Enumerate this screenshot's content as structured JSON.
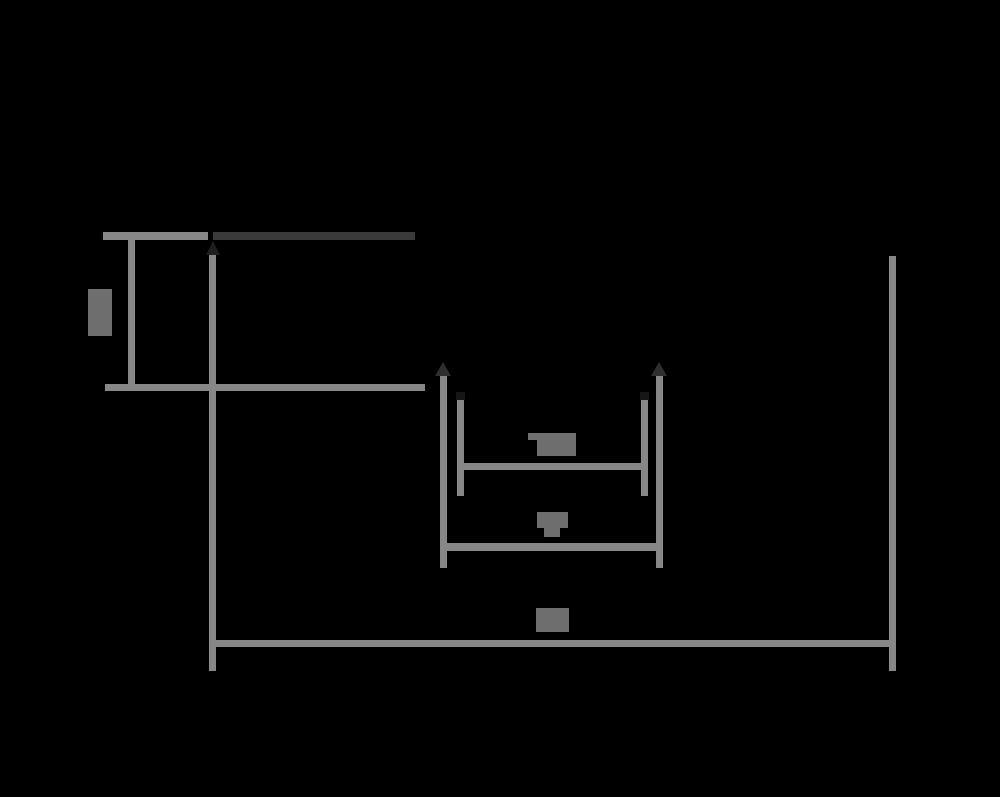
{
  "canvas": {
    "width": 1000,
    "height": 797,
    "background": "#000000"
  },
  "diagram": {
    "kind": "dimensioned-drawing",
    "colors": {
      "line": "#878787",
      "dark_edge_line": "#3a3a3a",
      "label_block": "#6e6e6e",
      "arrow_dark": "#2e2e2e",
      "arrow_faint": "#1e1e1e",
      "cap_dark": "#161616"
    },
    "labels": {
      "height": {
        "text": "",
        "legible": false,
        "style": "redacted-block"
      },
      "inner_width": {
        "text": "",
        "legible": false,
        "style": "redacted-block"
      },
      "outer_width": {
        "text": "",
        "legible": false,
        "style": "redacted-block"
      },
      "overall_width": {
        "text": "",
        "legible": false,
        "style": "redacted-block"
      }
    },
    "annotations": [
      {
        "id": "height-dimension",
        "orientation": "vertical",
        "has_arrows": false
      },
      {
        "id": "inner-width-dimension",
        "orientation": "horizontal",
        "has_arrows": true
      },
      {
        "id": "outer-width-dimension",
        "orientation": "horizontal",
        "has_arrows": true
      },
      {
        "id": "overall-width-dimension",
        "orientation": "horizontal",
        "has_arrows": true
      }
    ]
  }
}
